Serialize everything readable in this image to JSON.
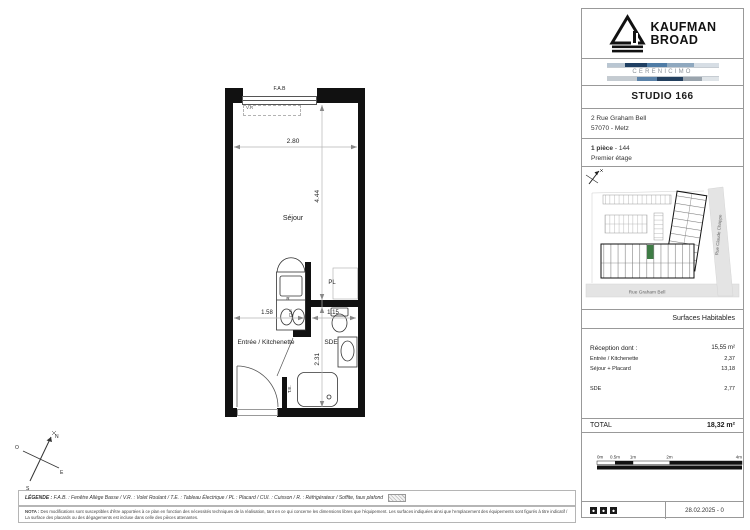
{
  "header": {
    "brand_line1": "KAUFMAN",
    "brand_line2": "BROAD",
    "distributor": "CERENICIMO",
    "title": "STUDIO 166",
    "address_line1": "2 Rue Graham Bell",
    "address_line2": "57070 - Metz",
    "rooms_bold": "1 pièce",
    "rooms_rest": " - 144",
    "floor": "Premier étage"
  },
  "site_map": {
    "street_right": "Rue Claude Chappe",
    "street_bottom": "Rue Graham Bell",
    "highlight_color": "#3e7c45"
  },
  "surfaces": {
    "header": "Surfaces Habitables",
    "rows": [
      {
        "label": "Réception dont :",
        "value": "15,55 m²"
      },
      {
        "label": "Entrée / Kitchenette",
        "value": "2,37"
      },
      {
        "label": "Séjour + Placard",
        "value": "13,18"
      },
      {
        "label": "SDE",
        "value": "2,77"
      }
    ],
    "total_label": "TOTAL",
    "total_value": "18,32 m²"
  },
  "scale_bar": {
    "labels": [
      "0m",
      "0.5m",
      "1m",
      "2m",
      "4m"
    ]
  },
  "revision": {
    "date": "28.02.2025 - 0"
  },
  "plan": {
    "labels": {
      "fab": "F.A.B",
      "vr": "V.R",
      "sejour": "Séjour",
      "pl": "PL",
      "r": "R",
      "cui": "CUI",
      "entree": "Entrée / Kitchenette",
      "sde": "SDE",
      "te": "T.E."
    },
    "dimensions": {
      "width_top": "2.80",
      "height_sejour": "4.44",
      "width_left": "1.58",
      "width_right": "1.15",
      "height_sde": "2.31"
    }
  },
  "compass": {
    "n": "N",
    "s": "S",
    "e": "E",
    "o": "O"
  },
  "legend": {
    "title": "LÉGENDE :",
    "text": " F.A.B. : Fenêtre Allège Basse  /  V.R. : Volet Roulant  /  T.E. : Tableau Électrique  /  PL : Placard  /  CUI. : Cuisson  /  R. : Réfrigérateur  /  Soffite, faux plafond"
  },
  "nota": {
    "title": "NOTA :",
    "text": " Des modifications sont susceptibles d'être apportées à ce plan en fonction des nécessités techniques de la réalisation, tant en ce qui concerne les dimensions libres que l'équipement. Les surfaces indiquées ainsi que l'emplacement des équipements sont figurés à titre indicatif / La surface des placards ou des dégagements est incluse dans celle des pièces attenantes."
  },
  "icons": {
    "brand_mark": "kaufman-broad-triangle-logo",
    "north_arrow": "north-arrow",
    "compass": "compass-rose",
    "certs": "certification-marks"
  }
}
